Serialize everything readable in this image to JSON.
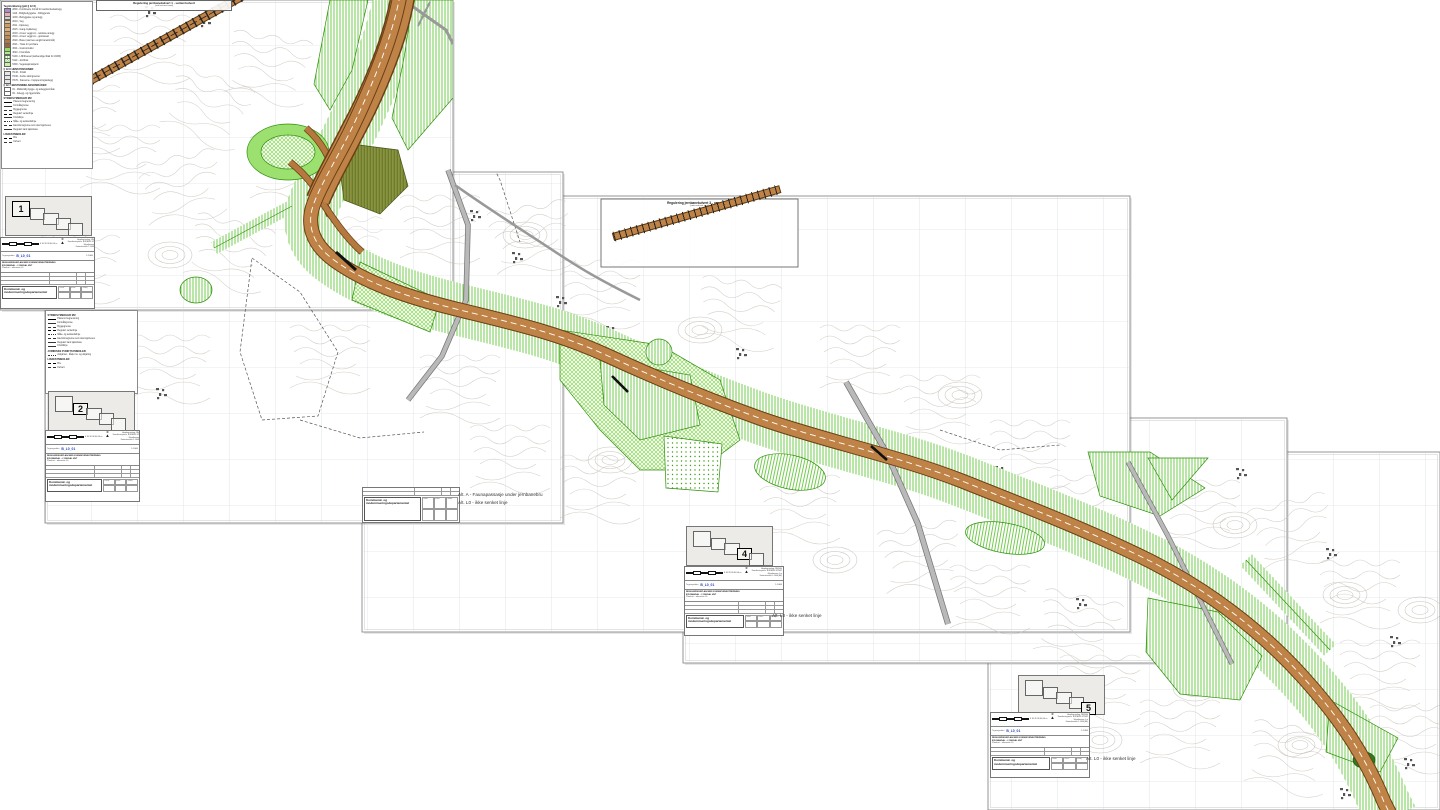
{
  "document_type": "reguleringsplan-kart",
  "colors": {
    "road_fill": "#c08347",
    "road_edge": "#6b3f16",
    "green_hatch": "#4fbf1f",
    "green_solid": "#9ce070",
    "olive": "#8a9440",
    "grid": "#ccd3db",
    "contour": "#c6bfb4",
    "gray_road": "#a9a9a9",
    "sheet_border": "#8a8a8a",
    "pond": "#2f7d1f",
    "code_blue": "#1d3fba"
  },
  "insets": [
    {
      "title": "Regulering jernbanekulvert 1 - senket kulvert",
      "subtitle": "(snitt sett mot nord)"
    },
    {
      "title": "Regulering jernbanekulvert 3 - over kulvert",
      "subtitle": "(snitt sett mot nord)"
    }
  ],
  "map_labels": [
    {
      "text": "Alt. A - Faunapassasje under jernbanebru",
      "x": 458,
      "y": 492
    },
    {
      "text": "Alt. L0 - ikke senket linje",
      "x": 458,
      "y": 500
    },
    {
      "text": "Alt. L0 - ikke senket linje",
      "x": 772,
      "y": 613
    },
    {
      "text": "Alt. L0 - ikke senket linje",
      "x": 1086,
      "y": 756
    }
  ],
  "minimaps": [
    {
      "number": "1",
      "active": 0
    },
    {
      "number": "2",
      "active": 1
    },
    {
      "number": "4",
      "active": 3
    },
    {
      "number": "5",
      "active": 4
    }
  ],
  "title_block": {
    "north": "N",
    "scalebar": "0  10  20  30  40  50 m",
    "meta_right": [
      "Høydegrunnlag: NN2000",
      "Koordinatsystem: EUREF89 UTM32",
      "Ekvidistanse 1 m",
      "Kartmålestokk 1:1000 (A1)"
    ],
    "date_label": "Tegningsdato",
    "drawing_code": "B_L0_01",
    "scale": "1:1000",
    "project_line1": "REGULERINGSPLAN MED KONSEKVENSUTREDNING",
    "project_line2": "E39 MANDAL – LYNGDAL ØST",
    "project_line3": "Plankart – alternativ L0",
    "org_line1": "Kommunal- og",
    "org_line2": "moderniseringsdepartementet",
    "cells": [
      "Utarb.",
      "Kontr.",
      "Godkj.",
      "",
      "",
      ""
    ]
  },
  "legend_main": {
    "items": [
      {
        "h": "Tegnforklaring (pbl § 12-5)"
      },
      {
        "swatch": "#a58fd0",
        "label": "2800 - Kombinerte formål for samferdselsanlegg"
      },
      {
        "swatch": "#e8aebc",
        "label": "1110 - Boligbebyggelse - frittliggende"
      },
      {
        "swatch": "#d9d2ca",
        "label": "1000 - Bebyggelse og anlegg"
      },
      {
        "swatch": "#e5c08c",
        "label": "2010 - Veg"
      },
      {
        "swatch": "#d69a5e",
        "label": "2011 - Kjøreveg"
      },
      {
        "swatch": "#dcb078",
        "label": "2015 - Gang-/sykkelveg"
      },
      {
        "swatch": "#cb9a62",
        "label": "2018 - Annen veggrunn - tekniske anlegg"
      },
      {
        "swatch": "#c28b52",
        "label": "2019 - Annen veggrunn - grøntareal"
      },
      {
        "swatch": "#b07846",
        "label": "2020 - Bane (nærmere angitt baneformål)"
      },
      {
        "swatch": "#9a6a3e",
        "label": "2021 - Trasé for jernbane"
      },
      {
        "swatch": "#8fe25a",
        "label": "3001 - Grønnstruktur"
      },
      {
        "swatch": "#b2ec8a",
        "label": "3040 - Friområde"
      },
      {
        "swatch": "vh",
        "label": "5100 - LNFR-areal (nødvendige tiltak for LNFR)"
      },
      {
        "swatch": "xh",
        "label": "5110 - Jordbruk"
      },
      {
        "swatch": "#c9f2a4",
        "label": "5300 - Vegetasjonsskjerm"
      },
      {
        "h": "§ 12-6 HENSYNSSONER"
      },
      {
        "swatch": "gh",
        "label": "H140 - Frisikt"
      },
      {
        "swatch": "gh",
        "label": "H190 - Andre sikringssoner"
      },
      {
        "swatch": "gh",
        "label": "H370 - Faresone - høyspenningsanlegg"
      },
      {
        "h": "§ 12-7 BESTEMMELSESOMRÅDER"
      },
      {
        "swatch": "none",
        "label": "#1 - Midlertidig bygge- og anleggsområde"
      },
      {
        "swatch": "none",
        "label": "#2 - Anlegg- og riggområde"
      },
      {
        "h": "STREKSYMBOLER MV."
      },
      {
        "line": "solid-bold",
        "label": "Planens begrensning"
      },
      {
        "line": "solid",
        "label": "Formålsgrense"
      },
      {
        "line": "dashed",
        "label": "Byggegrense"
      },
      {
        "line": "dashdot",
        "label": "Regulert senterlinje"
      },
      {
        "line": "solid",
        "label": "Frisiktlinje"
      },
      {
        "line": "dotted",
        "label": "Måle- og avstandslinje"
      },
      {
        "line": "dashed",
        "label": "Eiendomsgrense som skal oppheves"
      },
      {
        "line": "solid",
        "label": "Regulert kant kjørebane"
      },
      {
        "h": "LINJESYMBOLER"
      },
      {
        "line": "dashdot",
        "label": "Bru"
      },
      {
        "line": "dashed",
        "label": "Kulvert"
      }
    ]
  },
  "legend_lines": {
    "items": [
      {
        "h": "STREKSYMBOLER MV."
      },
      {
        "line": "solid-bold",
        "label": "Planens begrensning"
      },
      {
        "line": "solid",
        "label": "Formålsgrense"
      },
      {
        "line": "dashed",
        "label": "Byggegrense"
      },
      {
        "line": "dashdot",
        "label": "Regulert senterlinje"
      },
      {
        "line": "dotted",
        "label": "Måle- og avstandslinje"
      },
      {
        "line": "dashed",
        "label": "Eiendomsgrense som skal oppheves"
      },
      {
        "line": "solid",
        "label": "Regulert kant kjørebane"
      },
      {
        "line": "solid",
        "label": "Frisiktlinje"
      },
      {
        "h": "JURIDISKE PUNKTSYMBOLER"
      },
      {
        "line": "dotted",
        "label": "Avkjørsel - både inn- og utkjøring"
      },
      {
        "h": "LINJESYMBOLER"
      },
      {
        "line": "dashdot",
        "label": "Bru"
      },
      {
        "line": "dashed",
        "label": "Kulvert"
      }
    ]
  }
}
